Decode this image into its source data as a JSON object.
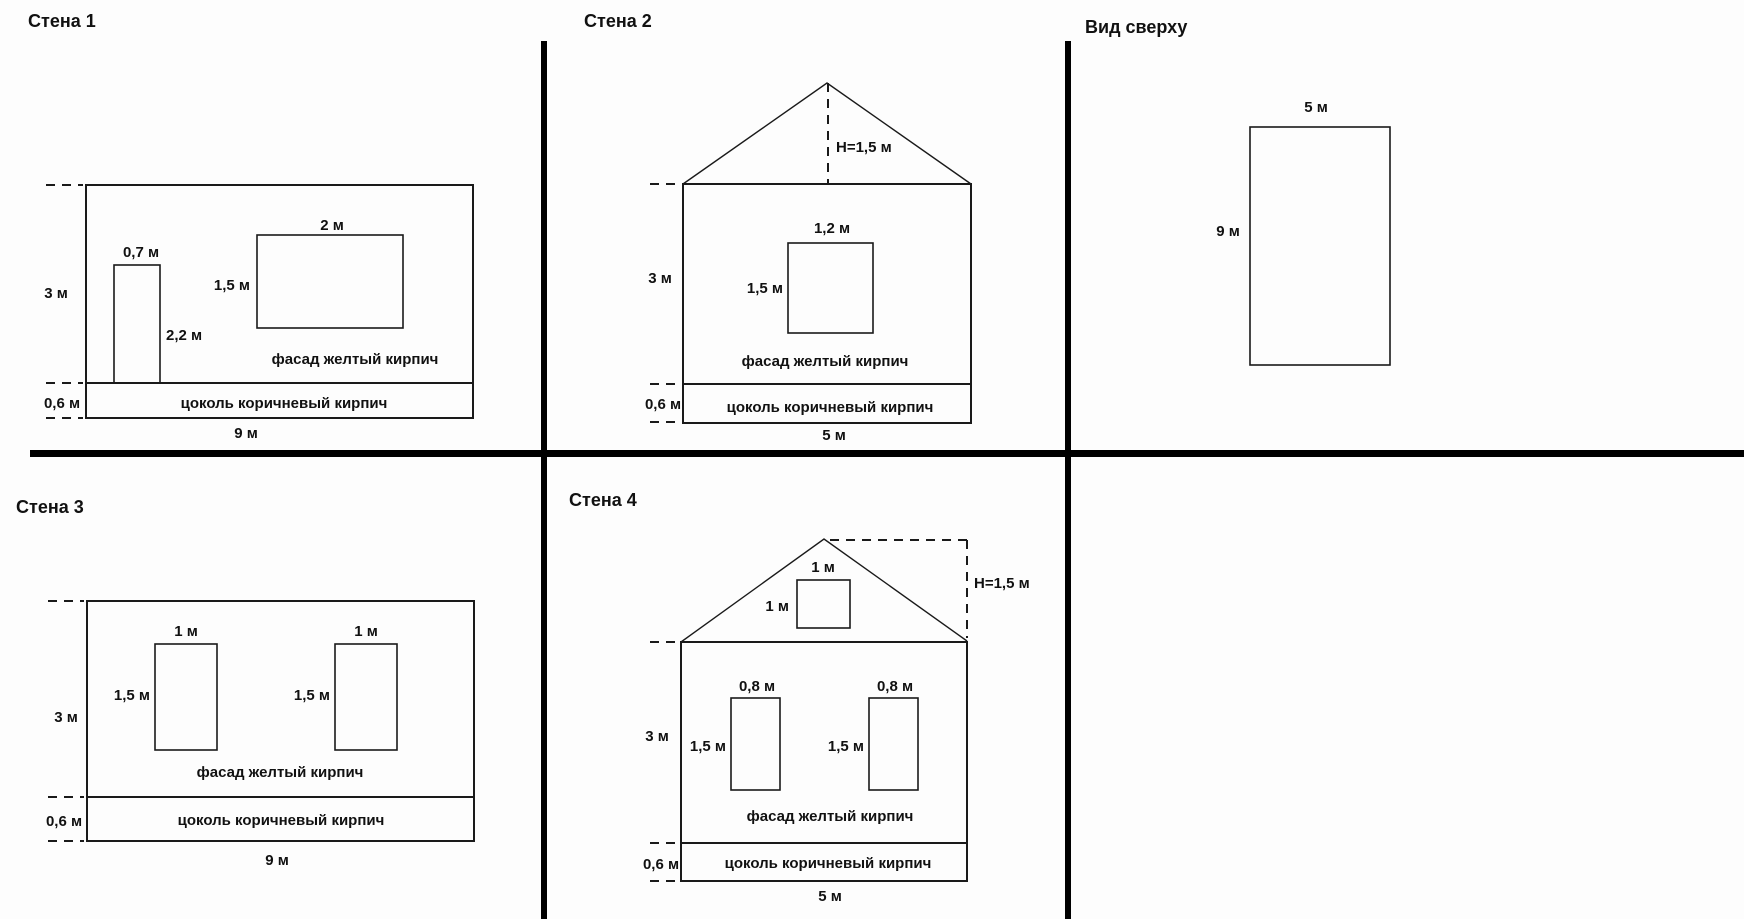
{
  "canvas": {
    "background": "#fdfdfd",
    "line_color": "#1a1a1a",
    "divider_color": "#000000"
  },
  "panels": [
    {
      "name": "wall-1",
      "title": "Стена 1",
      "shapes": [
        {
          "kind": "rect",
          "name": "facade",
          "x": 86,
          "y": 185,
          "w": 387,
          "h": 198,
          "sw": 2
        },
        {
          "kind": "rect",
          "name": "plinth",
          "x": 86,
          "y": 383,
          "w": 387,
          "h": 35,
          "sw": 2
        },
        {
          "kind": "rect",
          "name": "door",
          "x": 114,
          "y": 265,
          "w": 46,
          "h": 118,
          "sw": 1.6
        },
        {
          "kind": "rect",
          "name": "window",
          "x": 257,
          "y": 235,
          "w": 146,
          "h": 93,
          "sw": 1.6
        },
        {
          "kind": "dash",
          "name": "tick-top",
          "x1": 46,
          "y1": 185,
          "x2": 83,
          "y2": 185
        },
        {
          "kind": "dash",
          "name": "tick-facade-bottom",
          "x1": 46,
          "y1": 383,
          "x2": 83,
          "y2": 383
        },
        {
          "kind": "dash",
          "name": "tick-plinth-bottom",
          "x1": 46,
          "y1": 418,
          "x2": 83,
          "y2": 418
        }
      ],
      "labels": [
        {
          "text": "0,7 м",
          "x": 141,
          "y": 257,
          "anchor": "middle"
        },
        {
          "text": "2 м",
          "x": 332,
          "y": 230,
          "anchor": "middle"
        },
        {
          "text": "1,5 м",
          "x": 250,
          "y": 290,
          "anchor": "end"
        },
        {
          "text": "2,2 м",
          "x": 166,
          "y": 340,
          "anchor": "start"
        },
        {
          "text": "3 м",
          "x": 56,
          "y": 298,
          "anchor": "middle"
        },
        {
          "text": "0,6 м",
          "x": 62,
          "y": 408,
          "anchor": "middle"
        },
        {
          "text": "фасад желтый кирпич",
          "x": 355,
          "y": 364,
          "anchor": "middle"
        },
        {
          "text": "цоколь коричневый кирпич",
          "x": 284,
          "y": 408,
          "anchor": "middle"
        },
        {
          "text": "9 м",
          "x": 246,
          "y": 438,
          "anchor": "middle"
        }
      ]
    },
    {
      "name": "wall-2",
      "title": "Стена 2",
      "shapes": [
        {
          "kind": "poly",
          "name": "roof",
          "points": "683,184 827,83 971,184",
          "sw": 1.4
        },
        {
          "kind": "rect",
          "name": "facade",
          "x": 683,
          "y": 184,
          "w": 288,
          "h": 200,
          "sw": 2
        },
        {
          "kind": "rect",
          "name": "plinth",
          "x": 683,
          "y": 384,
          "w": 288,
          "h": 39,
          "sw": 2
        },
        {
          "kind": "rect",
          "name": "window",
          "x": 788,
          "y": 243,
          "w": 85,
          "h": 90,
          "sw": 1.6
        },
        {
          "kind": "dash",
          "name": "ridge-height-line",
          "x1": 828,
          "y1": 83,
          "x2": 828,
          "y2": 184
        },
        {
          "kind": "dash",
          "name": "tick-top",
          "x1": 650,
          "y1": 184,
          "x2": 677,
          "y2": 184
        },
        {
          "kind": "dash",
          "name": "tick-facade-bottom",
          "x1": 650,
          "y1": 384,
          "x2": 677,
          "y2": 384
        },
        {
          "kind": "dash",
          "name": "tick-plinth-bottom",
          "x1": 650,
          "y1": 422,
          "x2": 677,
          "y2": 422
        }
      ],
      "labels": [
        {
          "text": "Н=1,5 м",
          "x": 836,
          "y": 152,
          "anchor": "start"
        },
        {
          "text": "1,2 м",
          "x": 832,
          "y": 233,
          "anchor": "middle"
        },
        {
          "text": "1,5 м",
          "x": 783,
          "y": 293,
          "anchor": "end"
        },
        {
          "text": "3 м",
          "x": 660,
          "y": 283,
          "anchor": "middle"
        },
        {
          "text": "фасад желтый кирпич",
          "x": 825,
          "y": 366,
          "anchor": "middle"
        },
        {
          "text": "0,6 м",
          "x": 663,
          "y": 409,
          "anchor": "middle"
        },
        {
          "text": "цоколь коричневый кирпич",
          "x": 830,
          "y": 412,
          "anchor": "middle"
        },
        {
          "text": "5 м",
          "x": 834,
          "y": 440,
          "anchor": "middle"
        }
      ]
    },
    {
      "name": "top-view",
      "title": "Вид сверху",
      "shapes": [
        {
          "kind": "rect",
          "name": "plan-outline",
          "x": 1250,
          "y": 127,
          "w": 140,
          "h": 238,
          "sw": 1.6
        }
      ],
      "labels": [
        {
          "text": "5 м",
          "x": 1316,
          "y": 112,
          "anchor": "middle"
        },
        {
          "text": "9 м",
          "x": 1228,
          "y": 236,
          "anchor": "middle"
        }
      ]
    },
    {
      "name": "wall-3",
      "title": "Стена 3",
      "shapes": [
        {
          "kind": "rect",
          "name": "facade",
          "x": 87,
          "y": 601,
          "w": 387,
          "h": 196,
          "sw": 2
        },
        {
          "kind": "rect",
          "name": "plinth",
          "x": 87,
          "y": 797,
          "w": 387,
          "h": 44,
          "sw": 2
        },
        {
          "kind": "rect",
          "name": "window-left",
          "x": 155,
          "y": 644,
          "w": 62,
          "h": 106,
          "sw": 1.6
        },
        {
          "kind": "rect",
          "name": "window-right",
          "x": 335,
          "y": 644,
          "w": 62,
          "h": 106,
          "sw": 1.6
        },
        {
          "kind": "dash",
          "name": "tick-top",
          "x1": 48,
          "y1": 601,
          "x2": 84,
          "y2": 601
        },
        {
          "kind": "dash",
          "name": "tick-facade-bottom",
          "x1": 48,
          "y1": 797,
          "x2": 84,
          "y2": 797
        },
        {
          "kind": "dash",
          "name": "tick-plinth-bottom",
          "x1": 48,
          "y1": 841,
          "x2": 84,
          "y2": 841
        }
      ],
      "labels": [
        {
          "text": "1 м",
          "x": 186,
          "y": 636,
          "anchor": "middle"
        },
        {
          "text": "1 м",
          "x": 366,
          "y": 636,
          "anchor": "middle"
        },
        {
          "text": "1,5 м",
          "x": 150,
          "y": 700,
          "anchor": "end"
        },
        {
          "text": "1,5 м",
          "x": 330,
          "y": 700,
          "anchor": "end"
        },
        {
          "text": "3 м",
          "x": 66,
          "y": 722,
          "anchor": "middle"
        },
        {
          "text": "фасад желтый кирпич",
          "x": 280,
          "y": 777,
          "anchor": "middle"
        },
        {
          "text": "0,6 м",
          "x": 64,
          "y": 826,
          "anchor": "middle"
        },
        {
          "text": "цоколь коричневый кирпич",
          "x": 281,
          "y": 825,
          "anchor": "middle"
        },
        {
          "text": "9 м",
          "x": 277,
          "y": 865,
          "anchor": "middle"
        }
      ]
    },
    {
      "name": "wall-4",
      "title": "Стена 4",
      "shapes": [
        {
          "kind": "poly",
          "name": "roof",
          "points": "681,642 824,539 967,641",
          "sw": 1.4
        },
        {
          "kind": "rect",
          "name": "facade",
          "x": 681,
          "y": 642,
          "w": 286,
          "h": 201,
          "sw": 2
        },
        {
          "kind": "rect",
          "name": "plinth",
          "x": 681,
          "y": 843,
          "w": 286,
          "h": 38,
          "sw": 2
        },
        {
          "kind": "rect",
          "name": "attic-window",
          "x": 797,
          "y": 580,
          "w": 53,
          "h": 48,
          "sw": 1.6
        },
        {
          "kind": "rect",
          "name": "window-left",
          "x": 731,
          "y": 698,
          "w": 49,
          "h": 92,
          "sw": 1.6
        },
        {
          "kind": "rect",
          "name": "window-right",
          "x": 869,
          "y": 698,
          "w": 49,
          "h": 92,
          "sw": 1.6
        },
        {
          "kind": "dash",
          "name": "ridge-height-top",
          "x1": 830,
          "y1": 540,
          "x2": 967,
          "y2": 540
        },
        {
          "kind": "dash",
          "name": "ridge-height-line",
          "x1": 967,
          "y1": 540,
          "x2": 967,
          "y2": 638
        },
        {
          "kind": "dash",
          "name": "tick-top",
          "x1": 650,
          "y1": 642,
          "x2": 677,
          "y2": 642
        },
        {
          "kind": "dash",
          "name": "tick-facade-bottom",
          "x1": 650,
          "y1": 843,
          "x2": 677,
          "y2": 843
        },
        {
          "kind": "dash",
          "name": "tick-plinth-bottom",
          "x1": 650,
          "y1": 881,
          "x2": 677,
          "y2": 881
        }
      ],
      "labels": [
        {
          "text": "Н=1,5 м",
          "x": 974,
          "y": 588,
          "anchor": "start"
        },
        {
          "text": "1 м",
          "x": 823,
          "y": 572,
          "anchor": "middle"
        },
        {
          "text": "1 м",
          "x": 789,
          "y": 611,
          "anchor": "end"
        },
        {
          "text": "0,8 м",
          "x": 757,
          "y": 691,
          "anchor": "middle"
        },
        {
          "text": "0,8 м",
          "x": 895,
          "y": 691,
          "anchor": "middle"
        },
        {
          "text": "1,5 м",
          "x": 726,
          "y": 751,
          "anchor": "end"
        },
        {
          "text": "1,5 м",
          "x": 864,
          "y": 751,
          "anchor": "end"
        },
        {
          "text": "3 м",
          "x": 657,
          "y": 741,
          "anchor": "middle"
        },
        {
          "text": "фасад желтый кирпич",
          "x": 830,
          "y": 821,
          "anchor": "middle"
        },
        {
          "text": "0,6 м",
          "x": 661,
          "y": 869,
          "anchor": "middle"
        },
        {
          "text": "цоколь коричневый кирпич",
          "x": 828,
          "y": 868,
          "anchor": "middle"
        },
        {
          "text": "5 м",
          "x": 830,
          "y": 901,
          "anchor": "middle"
        }
      ]
    }
  ]
}
